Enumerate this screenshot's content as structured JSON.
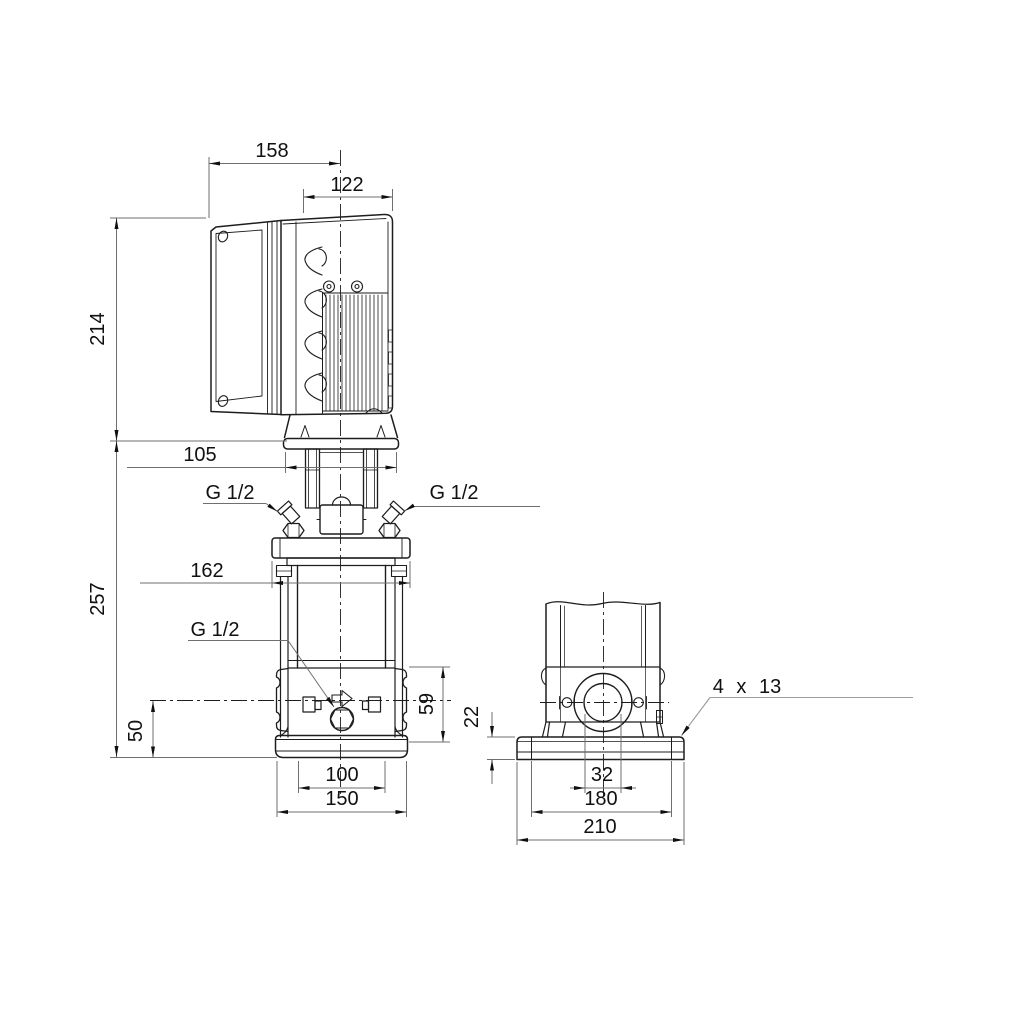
{
  "front_view": {
    "dimensions": {
      "overall_depth": "158",
      "motor_width": "122",
      "motor_height": "214",
      "fan_cover_width": "105",
      "pump_height": "257",
      "flange_width": "162",
      "port_height": "59",
      "drain_height": "50",
      "foot_holes_spacing": "100",
      "foot_width": "150"
    },
    "port_labels": {
      "vent_left": "G 1/2",
      "vent_right": "G 1/2",
      "drain": "G 1/2"
    }
  },
  "side_view": {
    "dimensions": {
      "baseplate_height": "22",
      "port_bore": "32",
      "bolt_spacing": "180",
      "baseplate_width": "210"
    },
    "labels": {
      "mounting_holes": "4 x 13"
    }
  },
  "colors": {
    "outline": "#1d1d1d",
    "dimension_line": "#6f6f6f",
    "leader_gray": "#9c9c9c",
    "text": "#101010",
    "background": "#ffffff"
  }
}
